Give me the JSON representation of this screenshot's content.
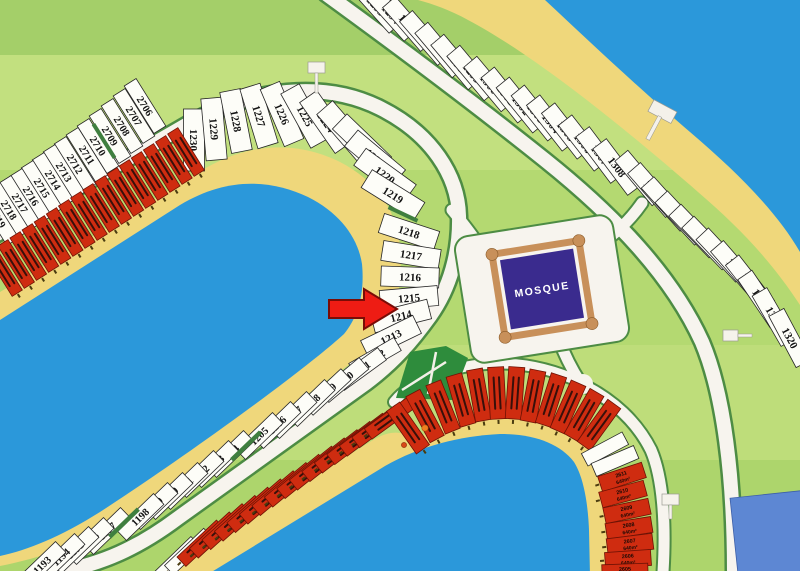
{
  "map": {
    "mosque_label": "MOSQUE",
    "highlight": {
      "target_plot": "1214",
      "marker": "red-arrow"
    },
    "colors": {
      "water": "#2b98da",
      "sand": "#efd77b",
      "road": "#f7f4ee",
      "road_edge": "#4d8c44",
      "plot_fill": "#fdfdf8",
      "plot_border": "#262626",
      "sold_fill": "#cf2c10",
      "sold_border": "#6e1205",
      "sold_text": "#38100a",
      "mosque_purple": "#3a2b8e",
      "mosque_frame": "#c8905a",
      "arrow": "#ee1c14",
      "arrow_outline": "#7a0c06",
      "park": "#2e8c3c",
      "building": "#5d87d3",
      "green_bands": [
        "#a4cf69",
        "#c2e07f",
        "#b4d971",
        "#bedd7a",
        "#add56c"
      ]
    },
    "plot_groups": [
      {
        "id": "plot-strip-nw",
        "depth": 56,
        "front": 14,
        "font": 10.5,
        "plots": [
          [
            "2706",
            145,
            106,
            58
          ],
          [
            "2707",
            134,
            116,
            58
          ],
          [
            "2708",
            122,
            126,
            58
          ],
          [
            "2709",
            110,
            136,
            58
          ],
          [
            "2710",
            98,
            146,
            58
          ],
          [
            "2711",
            87,
            155,
            58
          ],
          [
            "2712",
            75,
            164,
            58
          ],
          [
            "2713",
            64,
            172,
            58
          ],
          [
            "2714",
            53,
            180,
            58
          ],
          [
            "2715",
            42,
            188,
            58
          ],
          [
            "2716",
            31,
            196,
            58
          ],
          [
            "2717",
            20,
            203,
            58
          ],
          [
            "2718",
            9,
            210,
            58
          ],
          [
            "2719",
            -2,
            218,
            58
          ]
        ]
      },
      {
        "id": "plot-arc-upper",
        "depth": 62,
        "front": 21,
        "font": 11,
        "plots": [
          [
            "1230",
            194,
            140,
            90
          ],
          [
            "1229",
            214,
            129,
            85
          ],
          [
            "1228",
            236,
            121,
            79
          ],
          [
            "1227",
            259,
            116,
            73
          ],
          [
            "1226",
            282,
            114,
            67
          ],
          [
            "1225",
            305,
            116,
            61
          ],
          [
            "1224",
            326,
            122,
            55
          ],
          [
            "1223",
            345,
            131,
            49
          ],
          [
            "1222",
            362,
            143,
            44
          ],
          [
            "1221",
            375,
            158,
            40
          ],
          [
            "1220",
            385,
            175,
            36
          ],
          [
            "1219",
            393,
            195,
            32
          ]
        ]
      },
      {
        "id": "plot-col-east",
        "depth": 58,
        "front": 20,
        "font": 11,
        "plots": [
          [
            "1218",
            409,
            232,
            18
          ],
          [
            "1217",
            411,
            255,
            9
          ],
          [
            "1216",
            410,
            277,
            2
          ],
          [
            "1215",
            409,
            298,
            -5
          ],
          [
            "1214",
            401,
            316,
            -14
          ],
          [
            "1213",
            391,
            337,
            -26
          ]
        ]
      },
      {
        "id": "plot-strip-lower",
        "depth": 52,
        "front": 15,
        "font": 10.5,
        "plots": [
          [
            "1212",
            375,
            357,
            -30
          ],
          [
            "1211",
            361,
            369,
            -36
          ],
          [
            "1210",
            344,
            380,
            -40
          ],
          [
            "1209",
            327,
            392,
            -43
          ],
          [
            "1208",
            311,
            403,
            -44
          ],
          [
            "1207",
            293,
            415,
            -44
          ],
          [
            "1206",
            277,
            425,
            -44
          ],
          [
            "1205",
            259,
            436,
            -44
          ],
          [
            "1204",
            230,
            454,
            -44
          ],
          [
            "1203",
            215,
            464,
            -44
          ],
          [
            "1202",
            200,
            474,
            -44
          ],
          [
            "1201",
            184,
            486,
            -44
          ],
          [
            "1200",
            169,
            496,
            -44
          ],
          [
            "1199",
            154,
            506,
            -44
          ],
          [
            "1198",
            140,
            517,
            -44
          ],
          [
            "1197",
            107,
            531,
            -44
          ],
          [
            "1196",
            90,
            541,
            -44
          ],
          [
            "1195",
            75,
            550,
            -44
          ],
          [
            "1194",
            61,
            557,
            -44
          ],
          [
            "1193",
            42,
            565,
            -44
          ]
        ]
      },
      {
        "id": "plot-strip-topright",
        "depth": 58,
        "front": 17,
        "font": 11,
        "plots": [
          [
            "1293",
            376,
            6,
            48
          ],
          [
            "1294",
            391,
            14,
            48
          ],
          [
            "1295",
            408,
            24,
            49
          ],
          [
            "1296",
            425,
            38,
            49
          ],
          [
            "1297",
            440,
            50,
            50
          ],
          [
            "1298",
            456,
            62,
            50
          ],
          [
            "1299",
            472,
            73,
            50
          ],
          [
            "1300",
            489,
            84,
            50
          ],
          [
            "1301",
            506,
            95,
            51
          ],
          [
            "1302",
            521,
            105,
            51
          ],
          [
            "1303",
            536,
            113,
            51
          ],
          [
            "1304",
            551,
            123,
            52
          ],
          [
            "1305",
            566,
            131,
            52
          ],
          [
            "1306",
            583,
            143,
            52
          ],
          [
            "1307",
            600,
            155,
            53
          ],
          [
            "1308",
            617,
            167,
            53
          ]
        ]
      },
      {
        "id": "plot-strip-right",
        "depth": 58,
        "front": 17,
        "font": 11,
        "plots": [
          [
            "1309",
            640,
            178,
            50
          ],
          [
            "1310",
            653,
            190,
            49
          ],
          [
            "1311",
            667,
            204,
            48
          ],
          [
            "1312",
            681,
            218,
            47
          ],
          [
            "1313",
            695,
            231,
            46
          ],
          [
            "1314",
            708,
            243,
            46
          ],
          [
            "1315",
            722,
            255,
            47
          ],
          [
            "1316",
            736,
            268,
            49
          ],
          [
            "1317",
            750,
            283,
            52
          ],
          [
            "1318",
            761,
            299,
            56
          ],
          [
            "1319",
            774,
            317,
            60
          ],
          [
            "1320",
            790,
            338,
            62
          ]
        ]
      }
    ],
    "sold_rows": [
      {
        "id": "sold-row-nw",
        "x1": 186,
        "y1": 152,
        "x2": 4,
        "y2": 272,
        "count": 16,
        "depth": 50,
        "front": 12,
        "r1": 58,
        "r2": 58,
        "white_lead": 0,
        "beach_side": 1
      },
      {
        "id": "sold-row-lower",
        "x1": 176,
        "y1": 560,
        "x2": 390,
        "y2": 418,
        "count": 18,
        "depth": 54,
        "front": 13,
        "r1": -44,
        "r2": -36,
        "white_lead": 2,
        "beach_side": -1
      }
    ],
    "sold_arc": {
      "id": "sold-arc-lower",
      "depth": 52,
      "front": 16,
      "beach_side": 1,
      "plots": [
        [
          408,
          428,
          55
        ],
        [
          425,
          416,
          62
        ],
        [
          443,
          407,
          68
        ],
        [
          461,
          400,
          74
        ],
        [
          479,
          395,
          80
        ],
        [
          497,
          393,
          87
        ],
        [
          515,
          393,
          94
        ],
        [
          533,
          396,
          101
        ],
        [
          551,
          400,
          108
        ],
        [
          568,
          407,
          114
        ],
        [
          584,
          415,
          120
        ],
        [
          599,
          425,
          126
        ]
      ]
    },
    "sold_col": {
      "id": "sold-col-se",
      "depth": 46,
      "front": 16,
      "area_label": "640m²",
      "plots": [
        [
          "2611",
          622,
          477,
          -18
        ],
        [
          "2610",
          623,
          494,
          -15
        ],
        [
          "2609",
          627,
          511,
          -12
        ],
        [
          "2608",
          629,
          528,
          -9
        ],
        [
          "2607",
          630,
          544,
          -7
        ],
        [
          "2606",
          628,
          559,
          -4
        ],
        [
          "2605",
          625,
          572,
          -2
        ]
      ],
      "white_plots": [
        [
          605,
          449,
          -28
        ],
        [
          615,
          461,
          -23
        ]
      ]
    }
  }
}
